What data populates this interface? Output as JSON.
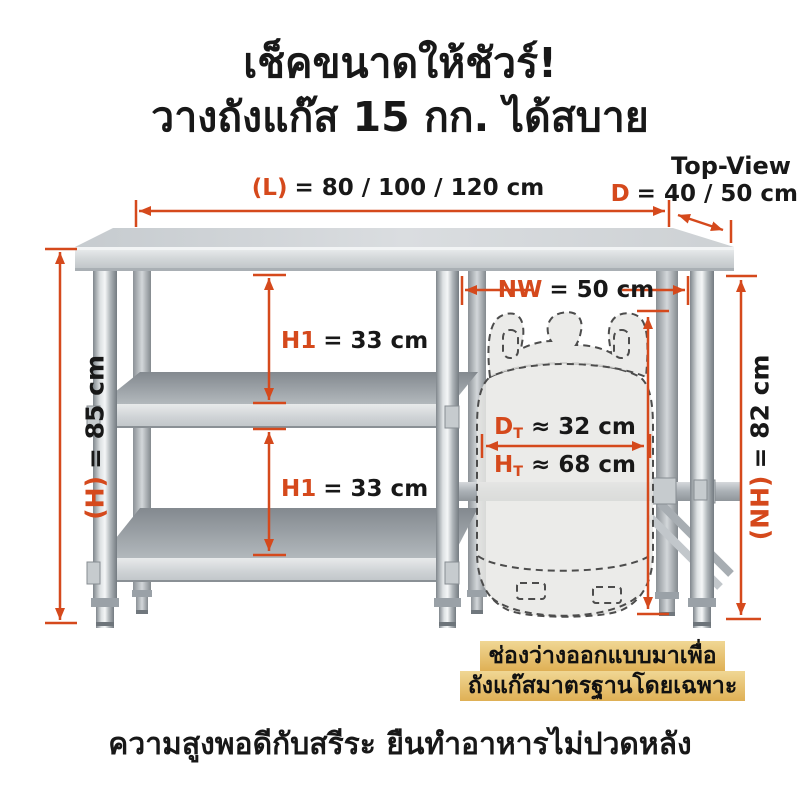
{
  "colors": {
    "accent": "#d5491c",
    "ink": "#181818",
    "gold-top": "#f0d794",
    "gold-bottom": "#dfb055",
    "steel-light": "#e9ebec",
    "steel-dark": "#7f868c"
  },
  "title": {
    "line1": "เช็คขนาดให้ชัวร์!",
    "line2": "วางถังแก๊ส 15 กก. ได้สบาย"
  },
  "top_view": {
    "label": "Top-View",
    "dim_prefix": "D",
    "dim_value": "= 40 / 50 cm"
  },
  "dimensions": {
    "length": {
      "prefix": "(L)",
      "value": "= 80 / 100 / 120 cm"
    },
    "height": {
      "prefix": "(H)",
      "value": "= 85 cm"
    },
    "net_height": {
      "prefix": "(NH)",
      "value": "= 82 cm"
    },
    "shelf_gap_upper": {
      "prefix": "H1",
      "value": "= 33 cm"
    },
    "shelf_gap_lower": {
      "prefix": "H1",
      "value": "= 33 cm"
    },
    "net_width": {
      "prefix": "NW",
      "value": "= 50 cm"
    },
    "tank_diameter": {
      "sym": "D",
      "sub": "T",
      "value": "≈ 32 cm"
    },
    "tank_height": {
      "sym": "H",
      "sub": "T",
      "value": "≈ 68 cm"
    }
  },
  "note": {
    "line1": "ช่องว่างออกแบบมาเพื่อ",
    "line2": "ถังแก๊สมาตรฐานโดยเฉพาะ"
  },
  "footer": {
    "text": "ความสูงพอดีกับสรีระ ยืนทำอาหารไม่ปวดหลัง"
  }
}
